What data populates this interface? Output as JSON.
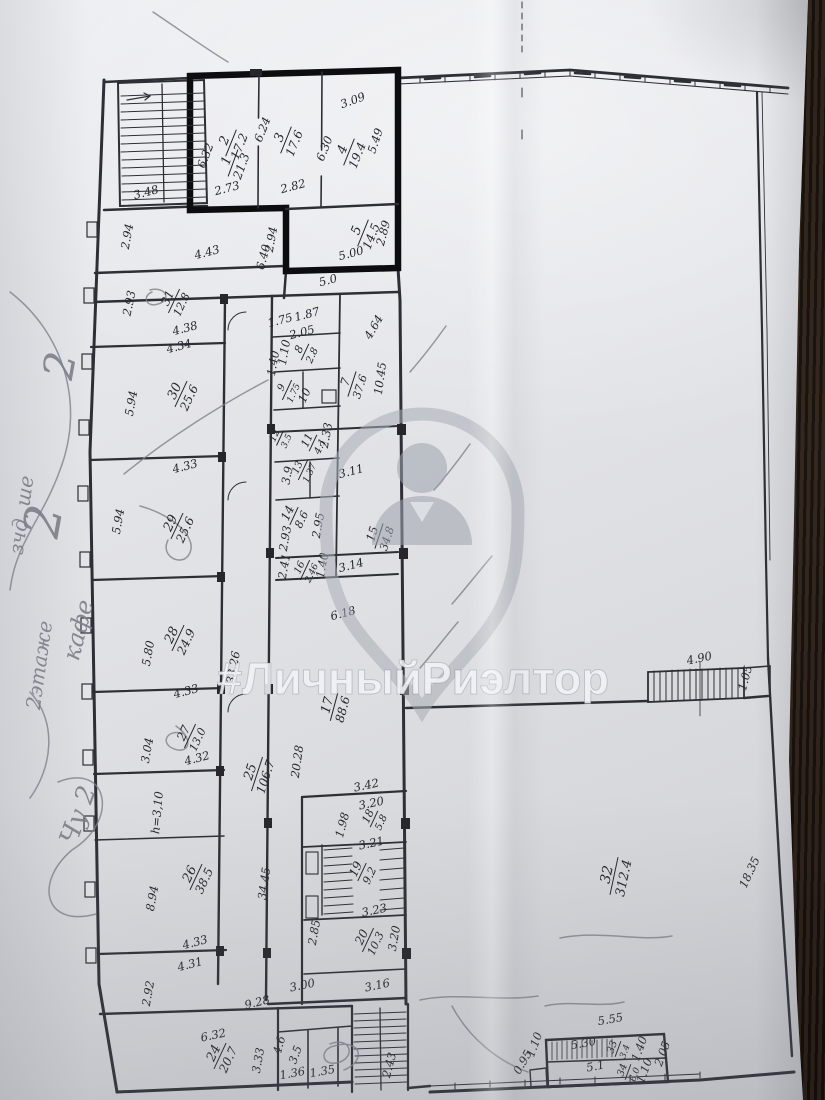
{
  "watermark": {
    "text": "#ЛичныйРиэлтор",
    "icon": "location-pin-person-silhouette"
  },
  "handwriting": {
    "items": [
      {
        "t": "2",
        "x": 74,
        "y": 368,
        "r": -80,
        "s": 42
      },
      {
        "t": "2",
        "x": 60,
        "y": 524,
        "r": -80,
        "s": 50
      },
      {
        "t": "зчд. ше",
        "x": 28,
        "y": 516,
        "r": -82,
        "s": 20
      },
      {
        "t": "2этаже",
        "x": 46,
        "y": 666,
        "r": -82,
        "s": 20
      },
      {
        "t": "кафе",
        "x": 86,
        "y": 632,
        "r": -76,
        "s": 24
      },
      {
        "t": "Чу 2",
        "x": 86,
        "y": 818,
        "r": -70,
        "s": 26
      }
    ]
  },
  "plan": {
    "rooms": [
      {
        "n": "1",
        "a": "21.3",
        "x": 233,
        "y": 163,
        "r": -70,
        "s": 13
      },
      {
        "n": "2",
        "a": "17.2",
        "x": 231,
        "y": 143,
        "r": -68,
        "s": 13
      },
      {
        "n": "3",
        "a": "17.6",
        "x": 286,
        "y": 140,
        "r": -68,
        "s": 13
      },
      {
        "n": "4",
        "a": "19.4",
        "x": 349,
        "y": 152,
        "r": -68,
        "s": 13
      },
      {
        "n": "5",
        "a": "14.5",
        "x": 363,
        "y": 233,
        "r": -68,
        "s": 13
      },
      {
        "n": "31",
        "a": "12.8",
        "x": 174,
        "y": 301,
        "r": -65,
        "s": 12
      },
      {
        "n": "30",
        "a": "25.6",
        "x": 181,
        "y": 394,
        "r": -65,
        "s": 13
      },
      {
        "n": "29",
        "a": "25.6",
        "x": 177,
        "y": 526,
        "r": -65,
        "s": 13
      },
      {
        "n": "28",
        "a": "24.9",
        "x": 178,
        "y": 638,
        "r": -65,
        "s": 13
      },
      {
        "n": "27",
        "a": "13.0",
        "x": 190,
        "y": 736,
        "r": -65,
        "s": 12
      },
      {
        "n": "26",
        "a": "38.5",
        "x": 196,
        "y": 877,
        "r": -65,
        "s": 13
      },
      {
        "n": "25",
        "a": "106.7",
        "x": 257,
        "y": 774,
        "r": -72,
        "s": 13
      },
      {
        "n": "24",
        "a": "20.7",
        "x": 220,
        "y": 1056,
        "r": -65,
        "s": 13
      },
      {
        "n": "7",
        "a": "37.6",
        "x": 352,
        "y": 384,
        "r": -72,
        "s": 12
      },
      {
        "n": "8",
        "a": "2.8",
        "x": 305,
        "y": 352,
        "r": -65,
        "s": 11
      },
      {
        "n": "9",
        "a": "1.75",
        "x": 287,
        "y": 390,
        "r": -65,
        "s": 10
      },
      {
        "n": "11",
        "a": "4.1",
        "x": 313,
        "y": 443,
        "r": -65,
        "s": 11
      },
      {
        "n": "12",
        "a": "3.5",
        "x": 280,
        "y": 438,
        "r": -65,
        "s": 10
      },
      {
        "n": "13",
        "a": "1.37",
        "x": 303,
        "y": 470,
        "r": -65,
        "s": 10
      },
      {
        "n": "14",
        "a": "8.6",
        "x": 294,
        "y": 516,
        "r": -65,
        "s": 12
      },
      {
        "n": "15",
        "a": "34.8",
        "x": 379,
        "y": 536,
        "r": -72,
        "s": 12
      },
      {
        "n": "16",
        "a": "2.46",
        "x": 305,
        "y": 570,
        "r": -65,
        "s": 10
      },
      {
        "n": "17",
        "a": "88.6",
        "x": 334,
        "y": 707,
        "r": -75,
        "s": 13
      },
      {
        "n": "18",
        "a": "5.8",
        "x": 374,
        "y": 819,
        "r": -65,
        "s": 11
      },
      {
        "n": "19",
        "a": "9.2",
        "x": 362,
        "y": 872,
        "r": -65,
        "s": 12
      },
      {
        "n": "20",
        "a": "10.3",
        "x": 368,
        "y": 940,
        "r": -65,
        "s": 12
      },
      {
        "n": "32",
        "a": "312.4",
        "x": 614,
        "y": 876,
        "r": -78,
        "s": 14
      },
      {
        "n": "33",
        "a": "3.4",
        "x": 618,
        "y": 1049,
        "r": -70,
        "s": 10
      },
      {
        "n": "34",
        "a": "6.0",
        "x": 628,
        "y": 1072,
        "r": -70,
        "s": 10
      }
    ],
    "dims": [
      {
        "t": "6.40",
        "x": 267,
        "y": 258,
        "r": -75
      },
      {
        "t": "6.32",
        "x": 209,
        "y": 157,
        "r": -68
      },
      {
        "t": "6.24",
        "x": 266,
        "y": 131,
        "r": -68
      },
      {
        "t": "6.30",
        "x": 328,
        "y": 150,
        "r": -68
      },
      {
        "t": "3.09",
        "x": 354,
        "y": 104,
        "r": -20
      },
      {
        "t": "5.49",
        "x": 379,
        "y": 142,
        "r": -72
      },
      {
        "t": "5.00",
        "x": 352,
        "y": 257,
        "r": -15
      },
      {
        "t": "2.89",
        "x": 387,
        "y": 234,
        "r": -75
      },
      {
        "t": "2.73",
        "x": 228,
        "y": 192,
        "r": -15
      },
      {
        "t": "2.82",
        "x": 294,
        "y": 190,
        "r": -15
      },
      {
        "t": "2.94",
        "x": 275,
        "y": 240,
        "r": -80
      },
      {
        "t": "2.94",
        "x": 131,
        "y": 237,
        "r": -80
      },
      {
        "t": "3.48",
        "x": 147,
        "y": 196,
        "r": -15
      },
      {
        "t": "4.43",
        "x": 208,
        "y": 256,
        "r": -15
      },
      {
        "t": "5.0",
        "x": 329,
        "y": 284,
        "r": -15
      },
      {
        "t": "2.93",
        "x": 133,
        "y": 304,
        "r": -78
      },
      {
        "t": "4.38",
        "x": 186,
        "y": 332,
        "r": -15
      },
      {
        "t": "4.34",
        "x": 180,
        "y": 350,
        "r": -15
      },
      {
        "t": "5.94",
        "x": 135,
        "y": 404,
        "r": -80
      },
      {
        "t": "4.33",
        "x": 186,
        "y": 470,
        "r": -15
      },
      {
        "t": "5.94",
        "x": 122,
        "y": 522,
        "r": -80
      },
      {
        "t": "5.80",
        "x": 152,
        "y": 654,
        "r": -80
      },
      {
        "t": "4.33",
        "x": 187,
        "y": 695,
        "r": -15
      },
      {
        "t": "3.04",
        "x": 151,
        "y": 751,
        "r": -80
      },
      {
        "t": "4.32",
        "x": 198,
        "y": 762,
        "r": -15
      },
      {
        "t": "h=3,10",
        "x": 161,
        "y": 813,
        "r": -85
      },
      {
        "t": "8.94",
        "x": 156,
        "y": 899,
        "r": -80
      },
      {
        "t": "4.33",
        "x": 196,
        "y": 946,
        "r": -15
      },
      {
        "t": "4.31",
        "x": 191,
        "y": 968,
        "r": -15
      },
      {
        "t": "2.92",
        "x": 152,
        "y": 994,
        "r": -80
      },
      {
        "t": "34.45",
        "x": 268,
        "y": 884,
        "r": -82
      },
      {
        "t": "20.28",
        "x": 301,
        "y": 762,
        "r": -82
      },
      {
        "t": "33.26",
        "x": 237,
        "y": 668,
        "r": -80
      },
      {
        "t": "1.75",
        "x": 281,
        "y": 324,
        "r": -15
      },
      {
        "t": "1.87",
        "x": 308,
        "y": 318,
        "r": -15
      },
      {
        "t": "2.05",
        "x": 303,
        "y": 336,
        "r": -15
      },
      {
        "t": "1.10",
        "x": 288,
        "y": 353,
        "r": -80
      },
      {
        "t": "1.40",
        "x": 277,
        "y": 364,
        "r": -80
      },
      {
        "t": "10",
        "x": 308,
        "y": 397,
        "r": -65
      },
      {
        "t": "10.45",
        "x": 384,
        "y": 379,
        "r": -82
      },
      {
        "t": "4.64",
        "x": 377,
        "y": 329,
        "r": -60
      },
      {
        "t": "2.33",
        "x": 330,
        "y": 436,
        "r": -80
      },
      {
        "t": "3.9",
        "x": 291,
        "y": 476,
        "r": -80
      },
      {
        "t": "3.11",
        "x": 352,
        "y": 475,
        "r": -15
      },
      {
        "t": "2.95",
        "x": 322,
        "y": 526,
        "r": -80
      },
      {
        "t": "2.93",
        "x": 289,
        "y": 539,
        "r": -80
      },
      {
        "t": "2.41",
        "x": 288,
        "y": 567,
        "r": -80
      },
      {
        "t": "1.40",
        "x": 326,
        "y": 566,
        "r": -80
      },
      {
        "t": "3.14",
        "x": 352,
        "y": 569,
        "r": -15
      },
      {
        "t": "6.18",
        "x": 344,
        "y": 617,
        "r": -15
      },
      {
        "t": "4.90",
        "x": 700,
        "y": 662,
        "r": -12
      },
      {
        "t": "1.05",
        "x": 749,
        "y": 679,
        "r": -75
      },
      {
        "t": "18.35",
        "x": 753,
        "y": 874,
        "r": -65
      },
      {
        "t": "3.42",
        "x": 367,
        "y": 789,
        "r": -12
      },
      {
        "t": "3.20",
        "x": 372,
        "y": 807,
        "r": -12
      },
      {
        "t": "1.98",
        "x": 346,
        "y": 826,
        "r": -75
      },
      {
        "t": "3.21",
        "x": 372,
        "y": 847,
        "r": -12
      },
      {
        "t": "3.23",
        "x": 375,
        "y": 914,
        "r": -12
      },
      {
        "t": "3.20",
        "x": 398,
        "y": 939,
        "r": -80
      },
      {
        "t": "3.16",
        "x": 378,
        "y": 989,
        "r": -12
      },
      {
        "t": "2.85",
        "x": 318,
        "y": 933,
        "r": -80
      },
      {
        "t": "9.28",
        "x": 258,
        "y": 1006,
        "r": -14
      },
      {
        "t": "3.00",
        "x": 303,
        "y": 989,
        "r": -12
      },
      {
        "t": "6.32",
        "x": 214,
        "y": 1039,
        "r": -12
      },
      {
        "t": "3.33",
        "x": 262,
        "y": 1061,
        "r": -80
      },
      {
        "t": "1.36",
        "x": 293,
        "y": 1077,
        "r": -10
      },
      {
        "t": "1.35",
        "x": 323,
        "y": 1075,
        "r": -10
      },
      {
        "t": "4.6",
        "x": 283,
        "y": 1046,
        "r": -75
      },
      {
        "t": "3.5",
        "x": 299,
        "y": 1056,
        "r": -70
      },
      {
        "t": "2.43",
        "x": 393,
        "y": 1066,
        "r": -75
      },
      {
        "t": "5.55",
        "x": 611,
        "y": 1023,
        "r": -10
      },
      {
        "t": "5.30",
        "x": 584,
        "y": 1047,
        "r": -10
      },
      {
        "t": "1.40",
        "x": 643,
        "y": 1050,
        "r": -70
      },
      {
        "t": "2.05",
        "x": 666,
        "y": 1055,
        "r": -70
      },
      {
        "t": "5.1",
        "x": 596,
        "y": 1070,
        "r": -10
      },
      {
        "t": "1.10",
        "x": 538,
        "y": 1046,
        "r": -70
      },
      {
        "t": "0.95",
        "x": 526,
        "y": 1064,
        "r": -60
      },
      {
        "t": "1.10",
        "x": 648,
        "y": 1072,
        "r": -70
      }
    ]
  }
}
